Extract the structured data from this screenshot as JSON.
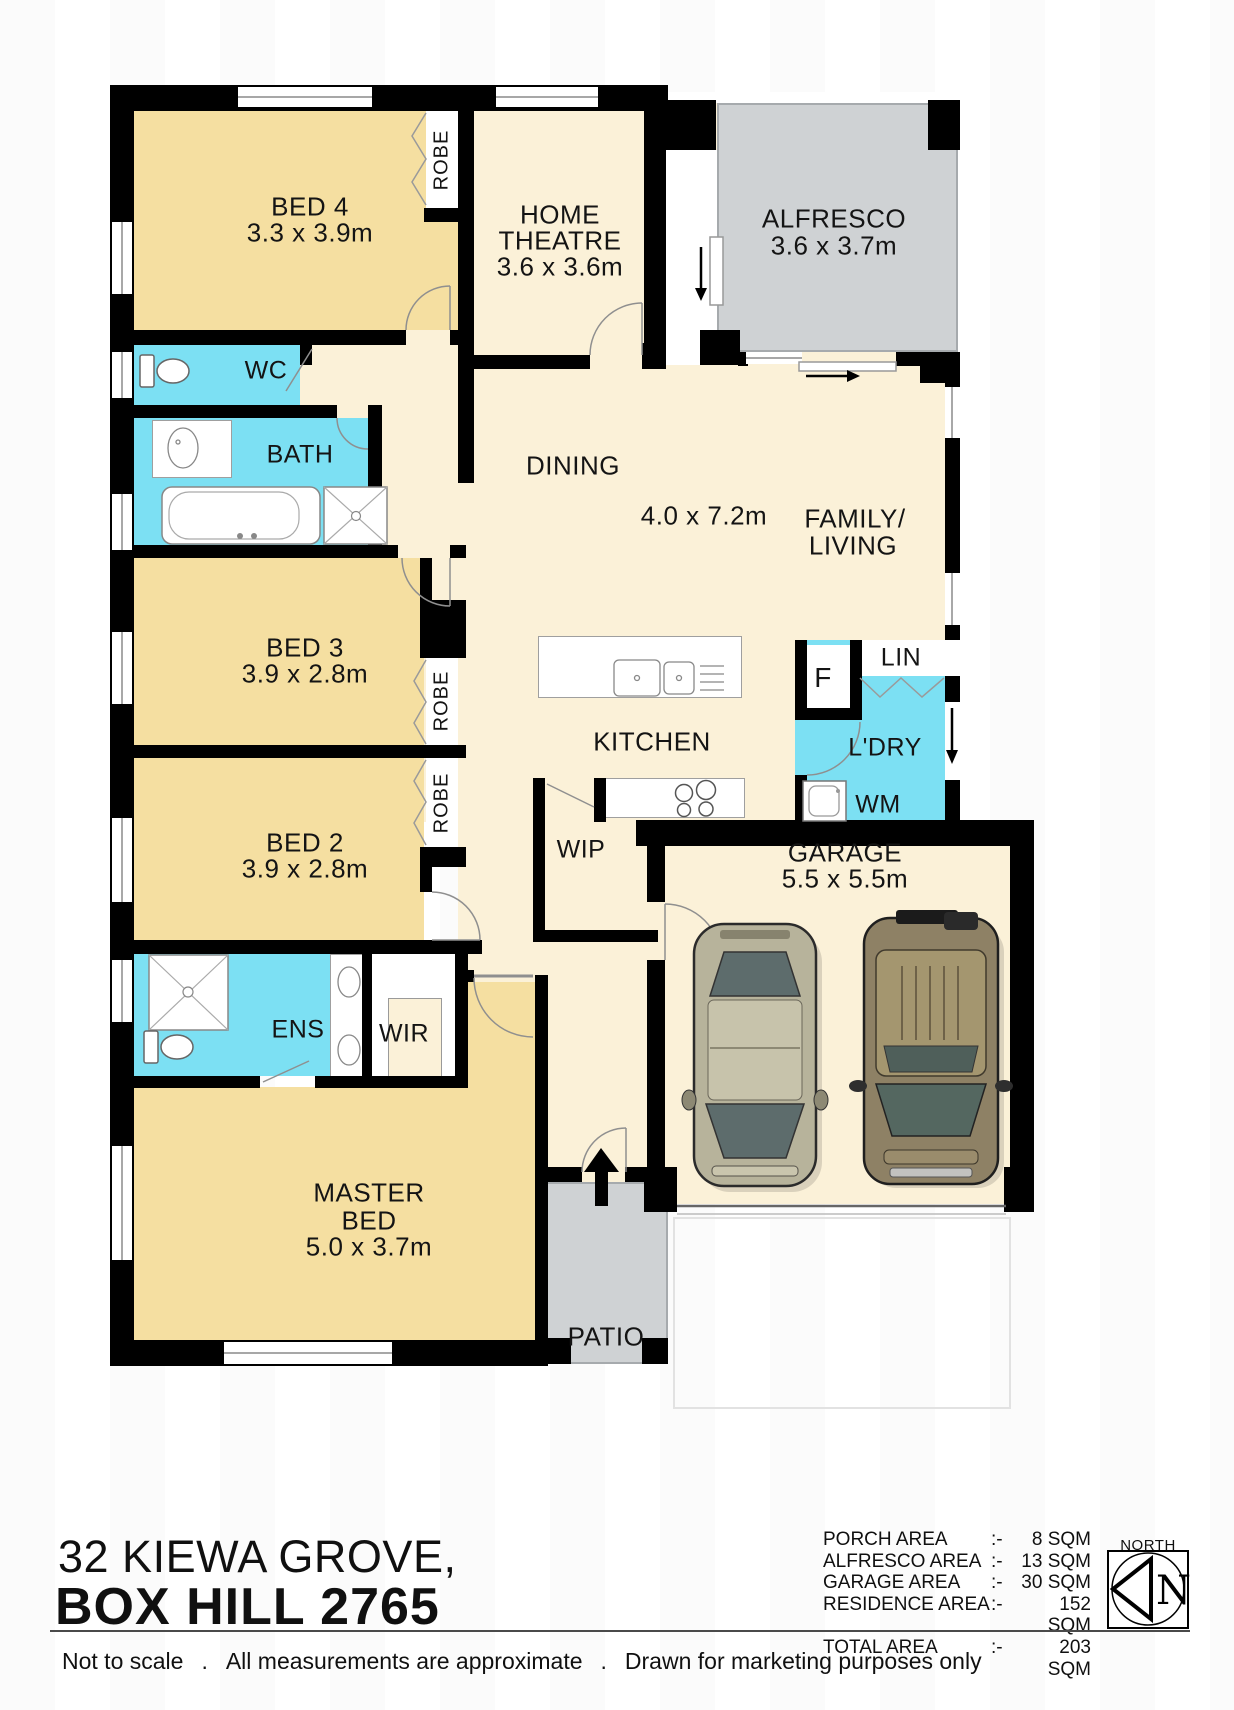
{
  "address": {
    "line1": "32 KIEWA GROVE,",
    "line2": "BOX HILL 2765"
  },
  "plan": {
    "rooms": {
      "bed4": {
        "name": "BED 4",
        "dims": "3.3 x 3.9m"
      },
      "theatre": {
        "line1": "HOME",
        "line2": "THEATRE",
        "dims": "3.6 x 3.6m"
      },
      "alfresco": {
        "name": "ALFRESCO",
        "dims": "3.6 x 3.7m"
      },
      "wc": {
        "name": "WC"
      },
      "bath": {
        "name": "BATH"
      },
      "dining": {
        "name": "DINING"
      },
      "open_dims": "4.0 x 7.2m",
      "family": {
        "line1": "FAMILY/",
        "line2": "LIVING"
      },
      "bed3": {
        "name": "BED 3",
        "dims": "3.9 x 2.8m"
      },
      "bed2": {
        "name": "BED 2",
        "dims": "3.9 x 2.8m"
      },
      "kitchen": {
        "name": "KITCHEN"
      },
      "wip": {
        "name": "WIP"
      },
      "fridge": {
        "name": "F"
      },
      "linen": {
        "name": "LIN"
      },
      "laundry": {
        "name": "L'DRY"
      },
      "wm": {
        "name": "WM"
      },
      "garage": {
        "name": "GARAGE",
        "dims": "5.5 x 5.5m"
      },
      "ens": {
        "name": "ENS"
      },
      "wir": {
        "name": "WIR"
      },
      "master": {
        "line1": "MASTER",
        "line2": "BED",
        "dims": "5.0 x 3.7m"
      },
      "patio": {
        "name": "PATIO"
      },
      "robe": "ROBE"
    }
  },
  "area_table": {
    "rows": [
      {
        "label": "PORCH AREA",
        "sep": ":-",
        "value": "8 SQM"
      },
      {
        "label": "ALFRESCO AREA",
        "sep": ":-",
        "value": "13 SQM"
      },
      {
        "label": "GARAGE AREA",
        "sep": ":-",
        "value": "30 SQM"
      },
      {
        "label": "RESIDENCE AREA",
        "sep": ":-",
        "value": "152 SQM"
      },
      {
        "label": "TOTAL AREA",
        "sep": ":-",
        "value": "203 SQM"
      }
    ]
  },
  "compass": {
    "label": "NORTH",
    "letter": "N"
  },
  "footer": {
    "part1": "Not to scale",
    "dot": ".",
    "part2": "All measurements are approximate",
    "part3": "Drawn for marketing purposes only"
  },
  "colors": {
    "bedroom": "#F5DFA1",
    "living": "#FBF1D8",
    "wet": "#7CE0F3",
    "outdoor": "#CFD2D4",
    "wall": "#000000"
  }
}
